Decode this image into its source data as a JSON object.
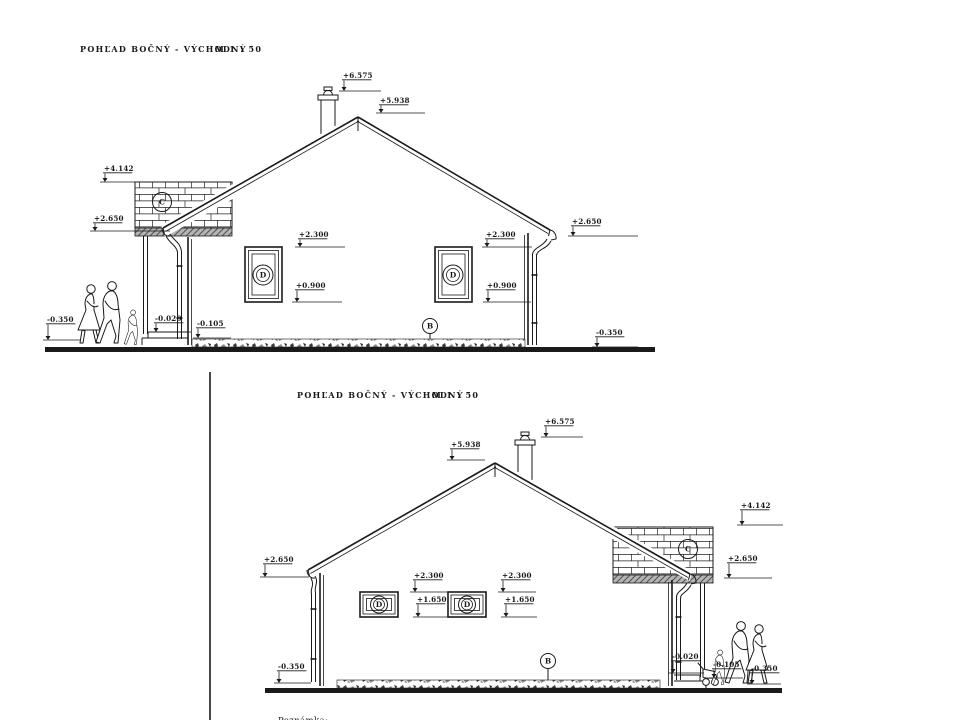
{
  "colors": {
    "ink": "#1a1a1a",
    "paper": "#ffffff"
  },
  "sheet1": {
    "title": "POHĽAD BOČNÝ - VÝCHODNÝ",
    "scale": "M 1 : 50",
    "markers": {
      "chimney_top": "+6.575",
      "ridge": "+5.938",
      "gable_wall_top": "+4.142",
      "eave_left": "+2.650",
      "eave_right": "+2.650",
      "window1_head": "+2.300",
      "window1_sill": "+0.900",
      "window2_head": "+2.300",
      "window2_sill": "+0.900",
      "porch_floor": "-0.020",
      "plinth": "-0.105",
      "ground_left": "-0.350",
      "ground_right": "-0.350"
    },
    "labels": {
      "gable_wall": "C",
      "window1": "D",
      "window2": "D",
      "plinth_ref": "B"
    }
  },
  "sheet2": {
    "title": "POHĽAD BOČNÝ - VÝCHODNÝ",
    "scale": "M 1 : 50",
    "note": "Poznámka:",
    "markers": {
      "chimney_top": "+6.575",
      "ridge": "+5.938",
      "gable_wall_top": "+4.142",
      "eave_left": "+2.650",
      "eave_right": "+2.650",
      "window1_head": "+2.300",
      "window1_sill": "+1.650",
      "window2_head": "+2.300",
      "window2_sill": "+1.650",
      "porch_floor": "-0.020",
      "plinth": "-0.105",
      "ground_left": "-0.350",
      "ground_right": "-0.350"
    },
    "labels": {
      "gable_wall": "C",
      "window1": "D",
      "window2": "D",
      "plinth_ref": "B"
    }
  }
}
